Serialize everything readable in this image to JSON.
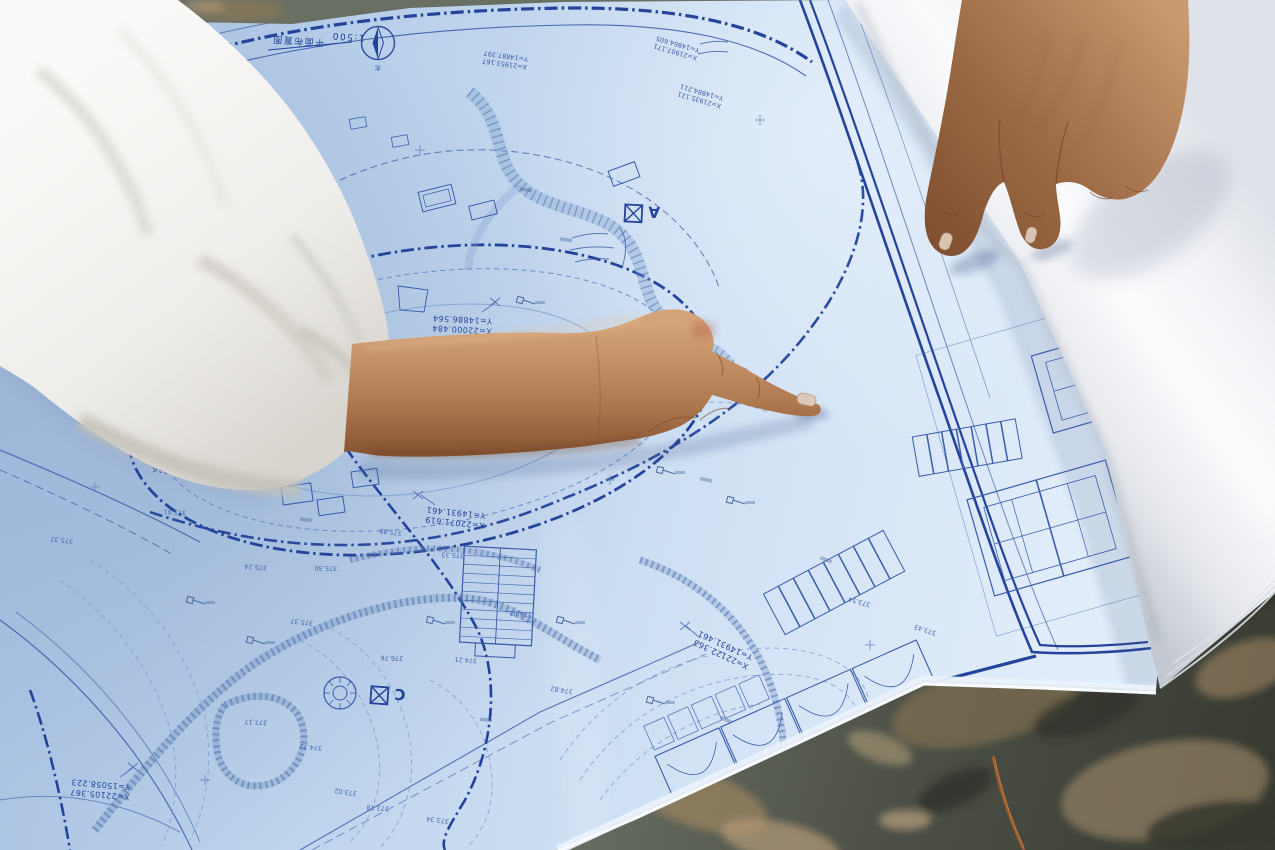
{
  "blueprint": {
    "title": "平面布置图",
    "scale_label": "1:500",
    "north_label": "北",
    "paper_color": "#c7daf1",
    "line_color": "#3a5cad",
    "bold_line_color": "#1f3d96",
    "zone_markers": [
      {
        "label": "A"
      },
      {
        "label": "C"
      }
    ],
    "coordinates": [
      {
        "x": "X=21958.732",
        "y": "Y=14919.326"
      },
      {
        "x": "X=22000.484",
        "y": "Y=14886.564"
      },
      {
        "x": "X=22071.619",
        "y": "Y=14931.461"
      },
      {
        "x": "X=22038.316",
        "y": "Y=15038.588"
      },
      {
        "x": "X=22105.367",
        "y": "Y=15058.223"
      },
      {
        "x": "X=22122.363",
        "y": "Y=14931.461"
      },
      {
        "x": "X=21953.167",
        "y": "Y=14887.397"
      },
      {
        "x": "X=21935.121",
        "y": "Y=14884.211"
      },
      {
        "x": "X=21907.171",
        "y": "Y=14864.605"
      }
    ],
    "spot_elevations": [
      "375.01",
      "375.32",
      "375.24",
      "375.30",
      "375.88",
      "375.33",
      "374.02",
      "374.82",
      "376.76",
      "375.37",
      "374.21",
      "373.02",
      "377.17",
      "374.72",
      "373.18",
      "375.59",
      "373.34",
      "373.54",
      "373.43",
      "374.54"
    ]
  },
  "colors": {
    "shirt": "#f3f2ef",
    "skin_light": "#d2a077",
    "skin_dark": "#8a5737",
    "roll_paper": "#f4f5f7",
    "ground_dark": "#3f4339",
    "ground_tan": "#b49a76"
  }
}
